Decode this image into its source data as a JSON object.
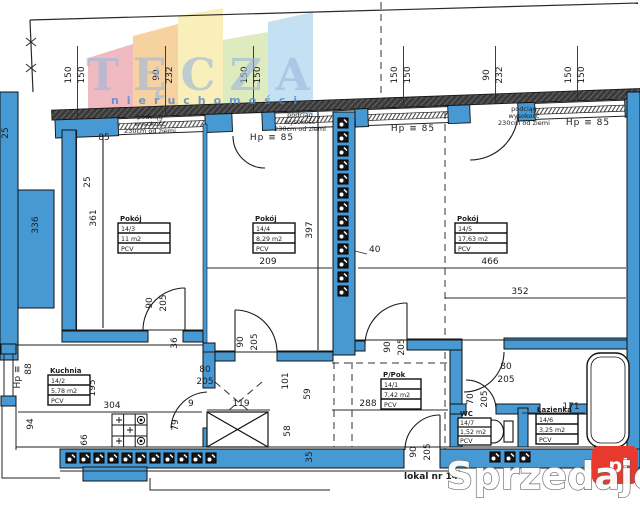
{
  "watermarks": {
    "brand": "TĘCZA",
    "brand_sub": "nieruchomości",
    "portal": "Sprzedajemy",
    "portal_badge": ".pl",
    "badge_color": "#e8392e",
    "brand_letter_color": "#9db8dc"
  },
  "top": {
    "window_dims": [
      "150",
      "150",
      "90",
      "232",
      "150",
      "150",
      "150",
      "150",
      "90",
      "232",
      "150",
      "150"
    ],
    "beam_note_1": [
      "podciąg",
      "wysokość",
      "230cm od ziemi"
    ],
    "beam_note_2": [
      "podciąg",
      "wysokość",
      "230cm od ziemi"
    ],
    "beam_note_3": [
      "podciąg",
      "wysokość",
      "230cm od ziemi"
    ],
    "sill_left": "85",
    "sill_1": "Hp ≡ 85",
    "sill_2": "Hp ≡ 85",
    "sill_3": "Hp ≡ 85"
  },
  "rooms": {
    "pokoj3": {
      "title": "Pokój",
      "id": "14/3",
      "area": "11 m2",
      "floor": "PCV"
    },
    "pokoj4": {
      "title": "Pokój",
      "id": "14/4",
      "area": "8,29 m2",
      "floor": "PCV"
    },
    "pokoj5": {
      "title": "Pokój",
      "id": "14/5",
      "area": "17,63 m2",
      "floor": "PCV"
    },
    "kuchnia": {
      "title": "Kuchnia",
      "id": "14/2",
      "area": "5,78 m2",
      "floor": "PCV"
    },
    "ppok": {
      "title": "P/Pok",
      "id": "14/1",
      "area": "7,42 m2",
      "floor": "PCV"
    },
    "wc": {
      "title": "WC",
      "id": "14/7",
      "area": "1,52 m2",
      "floor": "PCV"
    },
    "lazienka": {
      "title": "Łazienka",
      "id": "14/6",
      "area": "3,25 m2",
      "floor": "PCV"
    }
  },
  "dims": {
    "d25a": "25",
    "d25b": "25",
    "d336": "336",
    "d361": "361",
    "d397": "397",
    "d209": "209",
    "d466": "466",
    "d352": "352",
    "d40": "40",
    "door_l_w": "90",
    "door_l_h": "205",
    "door_m_w": "90",
    "door_m_h": "205",
    "door_r_w": "90",
    "door_r_h": "205",
    "entry_w": "90",
    "entry_h": "205",
    "hp_small": "Hp ≡",
    "d88": "88",
    "d195": "195",
    "d304": "304",
    "d94": "94",
    "d66": "66",
    "d36": "36",
    "kdoor_w": "80",
    "kdoor_h": "205",
    "d9": "9",
    "d119": "119",
    "d101": "101",
    "d59": "59",
    "d58": "58",
    "d35": "35",
    "d79": "79",
    "d288": "288",
    "cdoor_w": "80",
    "cdoor_h": "205",
    "wcdoor_w": "70",
    "wcdoor_h": "205",
    "d171": "171"
  },
  "unit_label": "lokal nr 14",
  "colors": {
    "wall_blue": "#4799d4",
    "line": "#1c1c1c"
  }
}
